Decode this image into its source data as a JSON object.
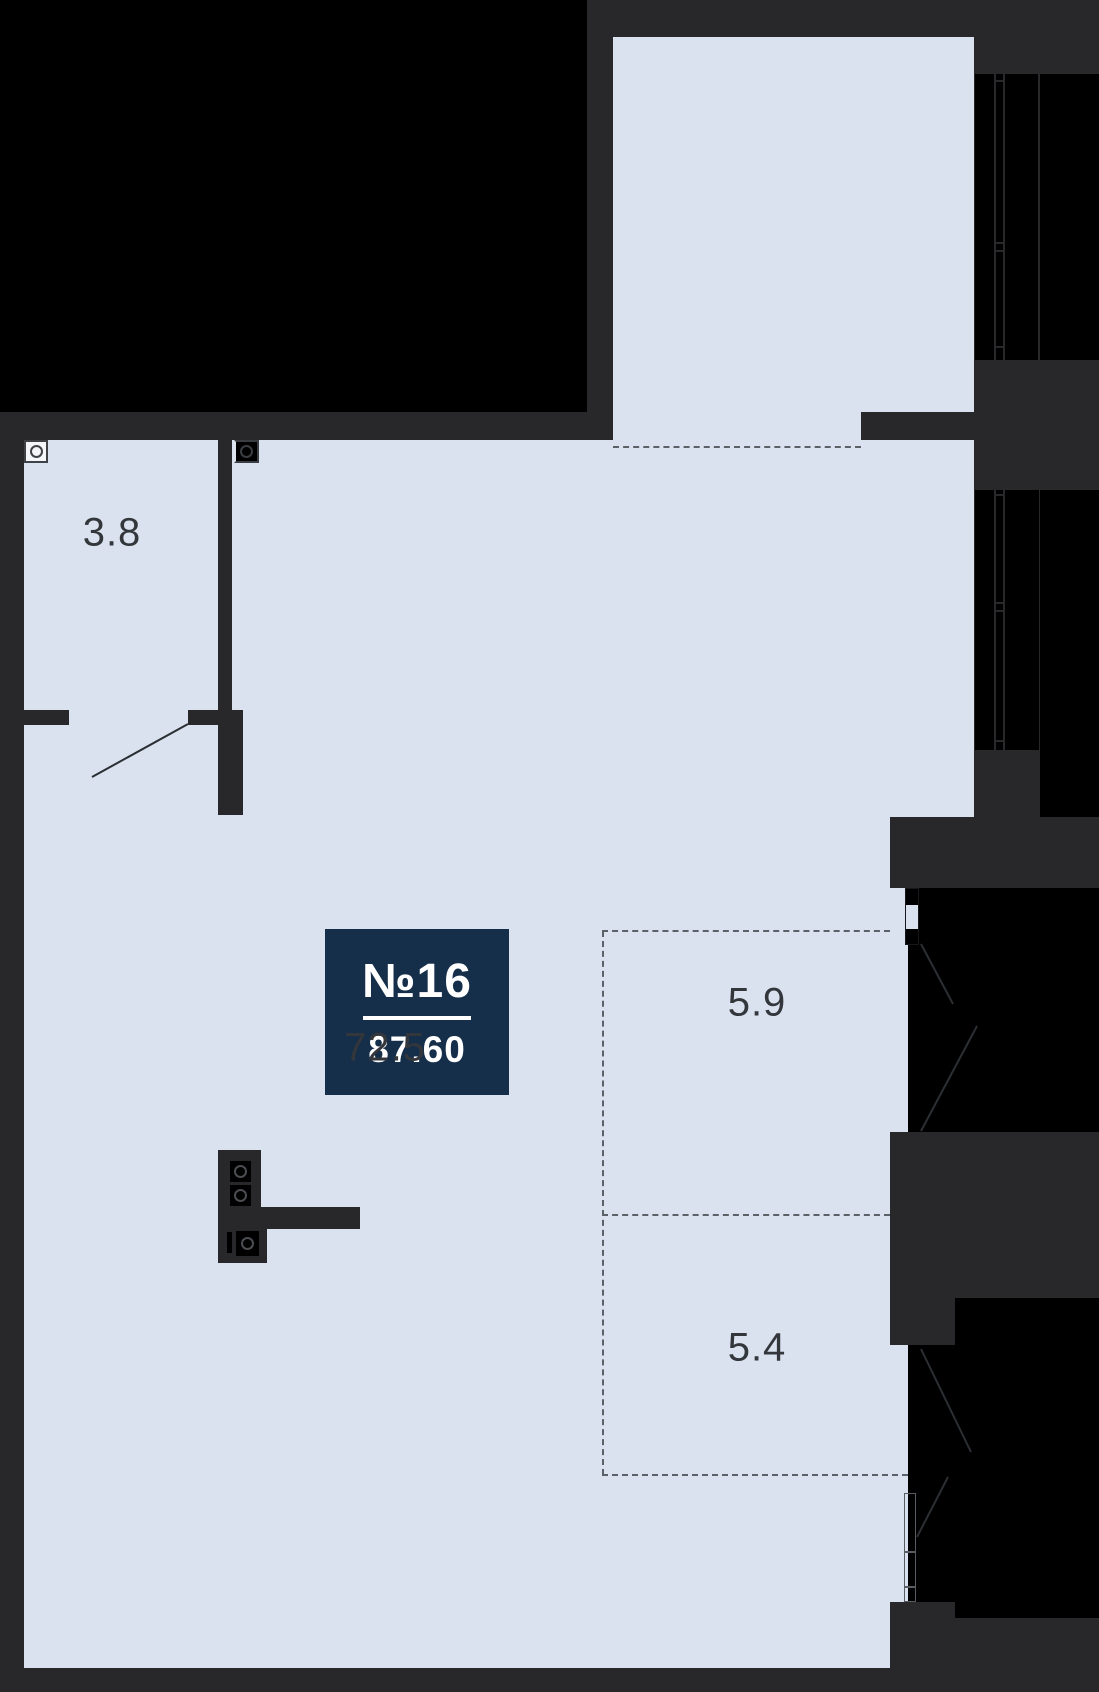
{
  "unit": {
    "number": "№16",
    "area": "87.60"
  },
  "rooms": [
    {
      "name": "hall",
      "label": "3.8"
    },
    {
      "name": "main-room",
      "label": "72.5"
    },
    {
      "name": "loggia-upper",
      "label": "5.9"
    },
    {
      "name": "loggia-lower",
      "label": "5.4"
    }
  ],
  "icons": {
    "ventilation": "circle-in-square",
    "stove_burner": "circle-in-square"
  },
  "colors": {
    "wall": "#28282a",
    "exterior": "#000000",
    "room_fill": "#d9e2ee",
    "badge": "#152e4a",
    "label_text": "#33373c",
    "dash": "#5c6167",
    "door_line": "#2b2f33",
    "white": "#ffffff"
  }
}
